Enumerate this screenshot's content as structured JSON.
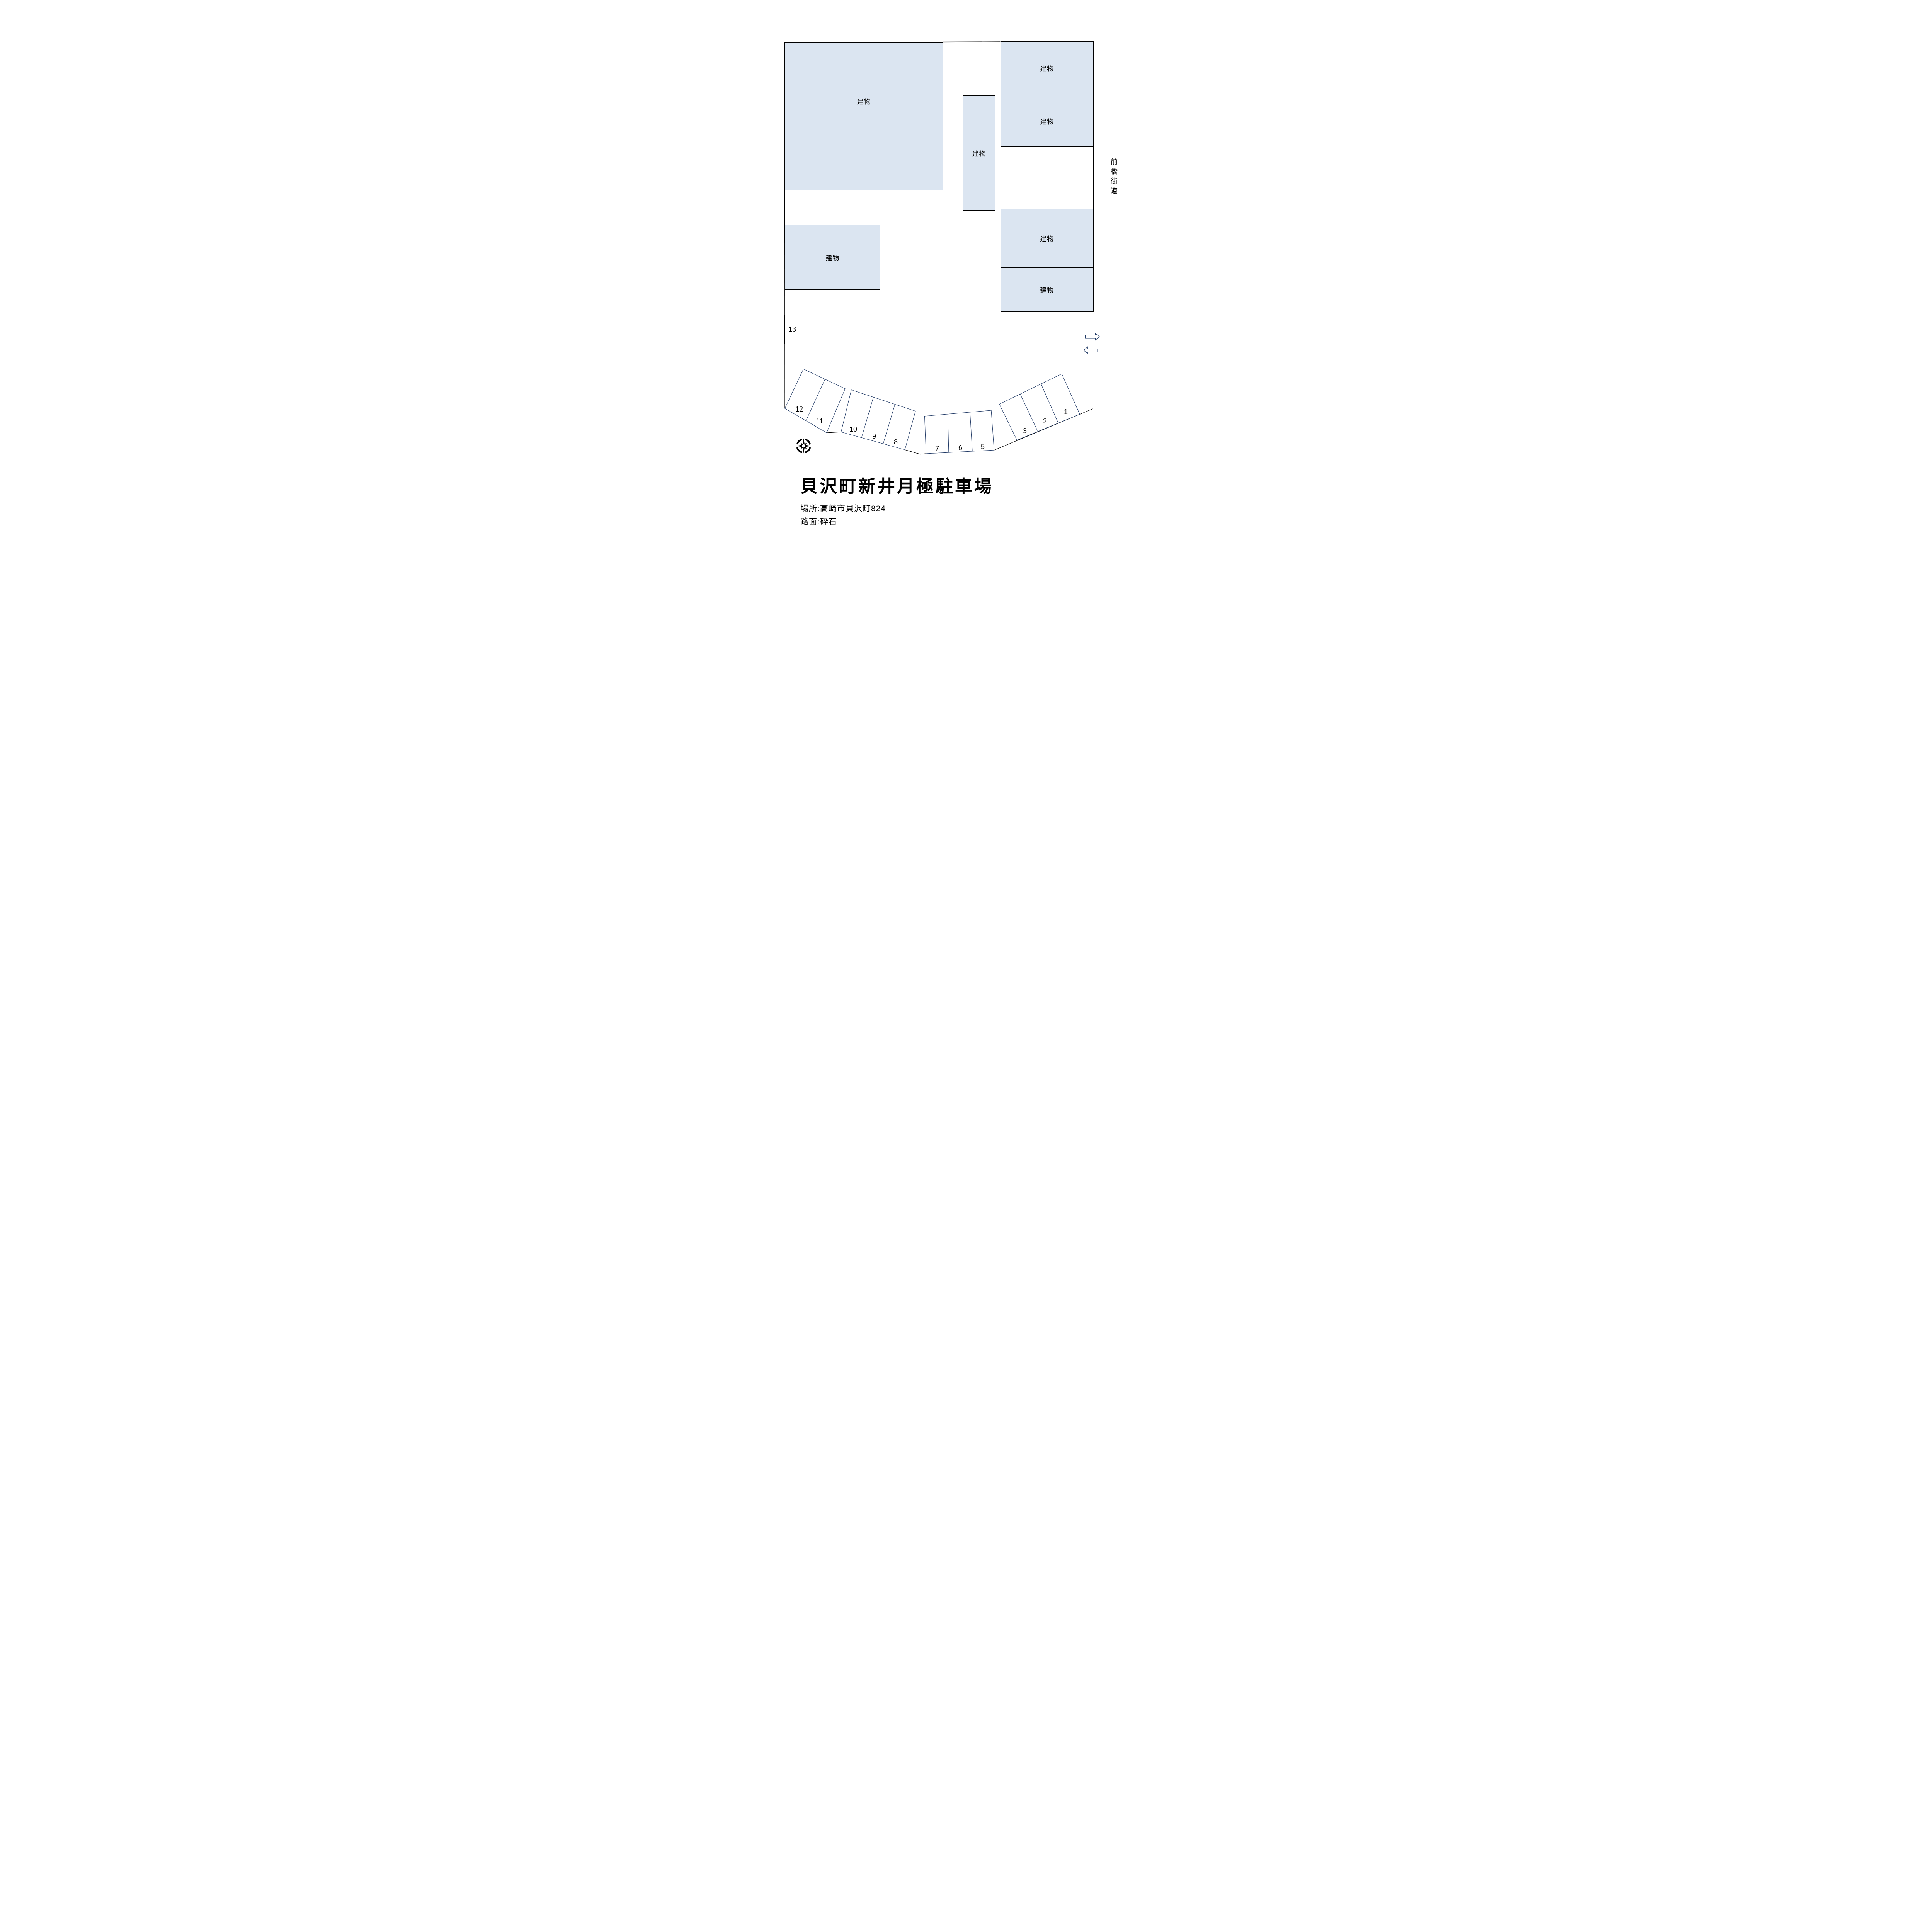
{
  "map": {
    "buildings": [
      {
        "id": "building-large-northwest",
        "label": "建物"
      },
      {
        "id": "building-center-vertical",
        "label": "建物"
      },
      {
        "id": "building-northeast-1",
        "label": "建物"
      },
      {
        "id": "building-northeast-2",
        "label": "建物"
      },
      {
        "id": "building-east-3",
        "label": "建物"
      },
      {
        "id": "building-east-4",
        "label": "建物"
      },
      {
        "id": "building-west-lower",
        "label": "建物"
      }
    ],
    "road": {
      "label": "前橋街道"
    },
    "spaces": [
      {
        "label": "13"
      },
      {
        "label": "12"
      },
      {
        "label": "11"
      },
      {
        "label": "10"
      },
      {
        "label": "9"
      },
      {
        "label": "8"
      },
      {
        "label": "7"
      },
      {
        "label": "6"
      },
      {
        "label": "5"
      },
      {
        "label": "3"
      },
      {
        "label": "2"
      },
      {
        "label": "1"
      }
    ],
    "icons": {
      "compass": "compass-rose",
      "traffic_arrow_right": "arrow-right",
      "traffic_arrow_left": "arrow-left"
    }
  },
  "footer": {
    "title": "貝沢町新井月極駐車場",
    "location_line": "場所:高崎市貝沢町824",
    "surface_line": "路面:砕石"
  },
  "colors": {
    "background": "#ffffff",
    "building_fill": "#dbe5f1",
    "building_stroke": "#000000",
    "parking_stroke": "#1f3864",
    "boundary_stroke": "#000000",
    "text": "#000000"
  }
}
